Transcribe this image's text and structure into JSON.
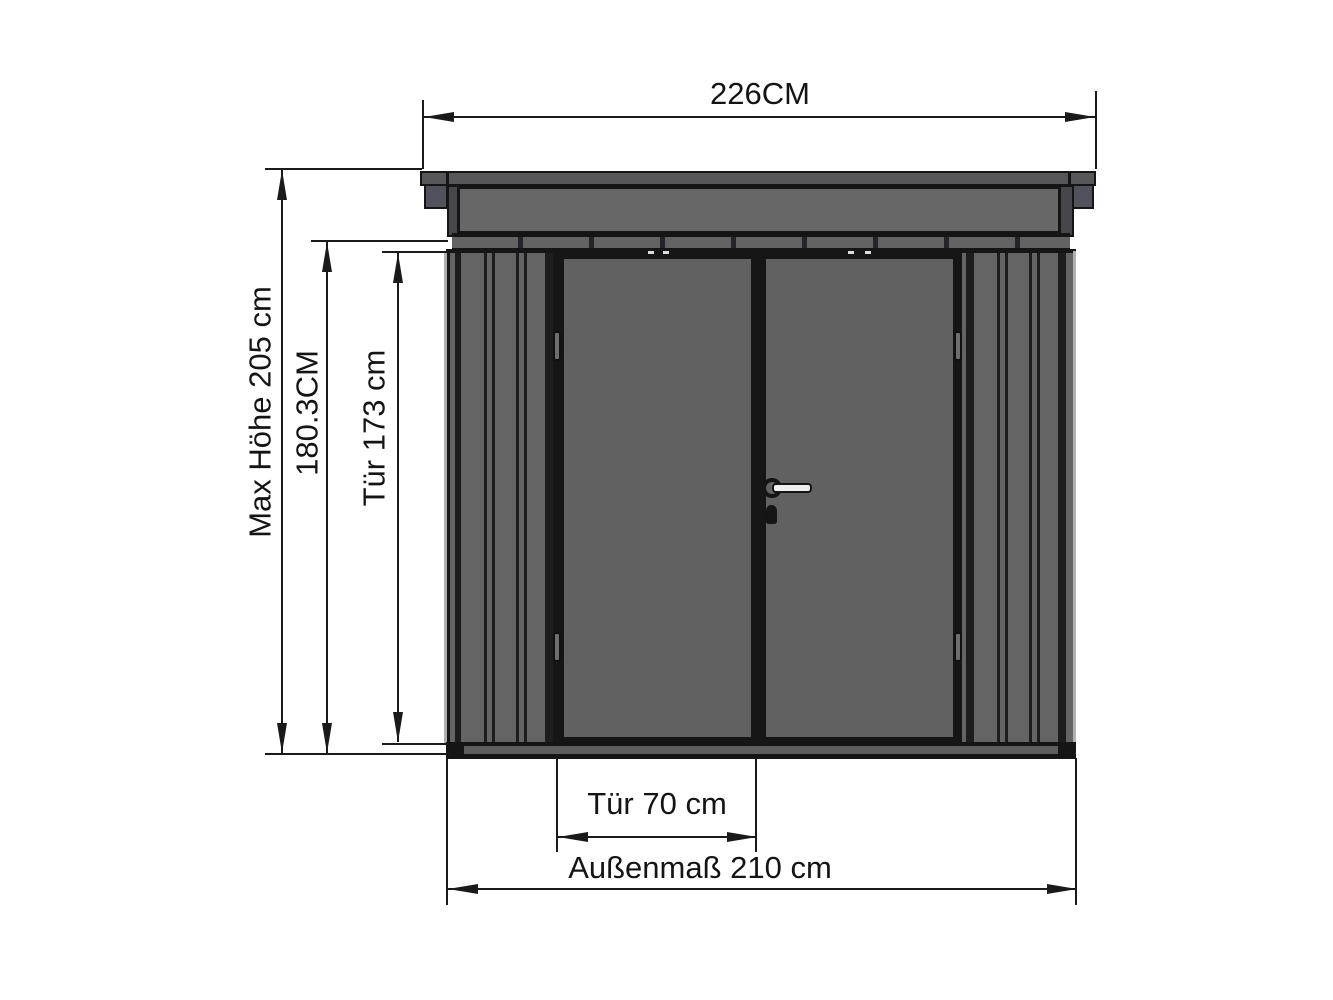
{
  "diagram": {
    "type": "technical-drawing-front-elevation",
    "dimensions": {
      "roof_width": "226CM",
      "max_height": "Max Höhe 205 cm",
      "wall_height": "180.3CM",
      "door_height": "Tür 173 cm",
      "door_width": "Tür 70 cm",
      "outer_width": "Außenmaß 210 cm"
    },
    "colors": {
      "background": "#ffffff",
      "outline": "#151515",
      "panel_gray": "#616161",
      "wall_gray": "#646464",
      "roof_gray": "#57575a",
      "end_cap_gray": "#52525c",
      "dimension_line": "#1a1a1a"
    }
  }
}
